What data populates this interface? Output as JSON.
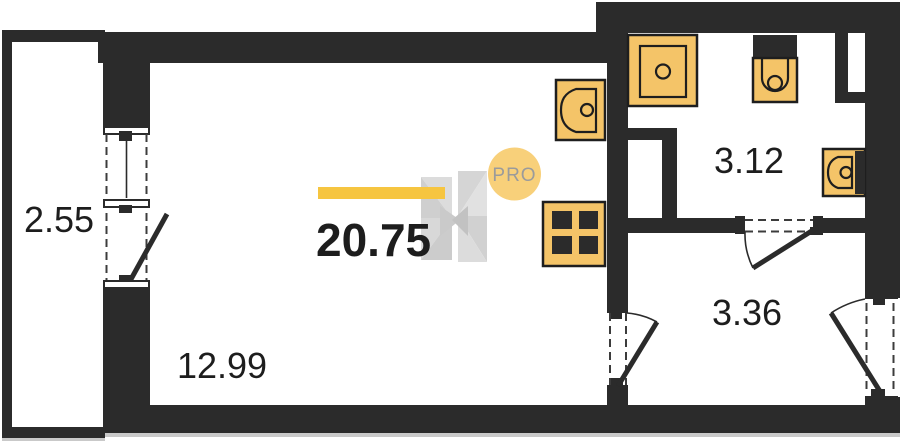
{
  "plan": {
    "title": "studio-floor-plan",
    "total": {
      "area": "20.75"
    },
    "rooms": [
      {
        "id": "balcony",
        "area": "2.55"
      },
      {
        "id": "living-room",
        "area": "12.99"
      },
      {
        "id": "bathroom",
        "area": "3.12"
      },
      {
        "id": "hallway",
        "area": "3.36"
      }
    ],
    "fixtures": [
      "kitchen-sink",
      "stove",
      "shower",
      "toilet",
      "washbasin"
    ]
  },
  "watermark": {
    "badge": "PRO",
    "logo": "h-logo"
  },
  "colors": {
    "wall": "#2b2b2b",
    "fixture_fill": "#f4c468",
    "fixture_stroke": "#1e1e1e",
    "accent_bar": "#f6c540",
    "badge_fill": "#f8d07a",
    "badge_text": "#9b9b9b",
    "label_text": "#1d1d1d"
  }
}
